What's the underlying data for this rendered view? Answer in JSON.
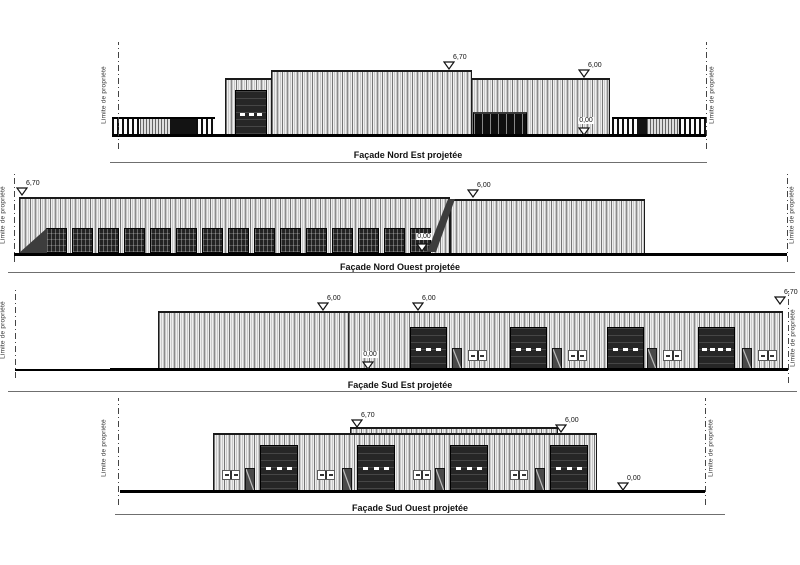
{
  "drawing": {
    "property_limit_label": "Limite de propriété",
    "colors": {
      "line": "#1a1a1a",
      "cladding": "#efefef",
      "door_dark": "#262626",
      "ground": "#000000",
      "shade": "#3d3d3d"
    },
    "elevations": [
      {
        "name": "facade-nord-est",
        "title": "Façade Nord Est projetée",
        "title_cx": 408,
        "title_y": 150,
        "underline": {
          "x1": 110,
          "x2": 707,
          "y": 162
        },
        "property_lines": [
          {
            "x": 118,
            "y1": 42,
            "y2": 149,
            "label_x": 104,
            "label_cy": 95
          },
          {
            "x": 706,
            "y1": 42,
            "y2": 149,
            "label_x": 712,
            "label_cy": 95
          }
        ],
        "grounds": [
          {
            "x1": 112,
            "x2": 706,
            "y": 134,
            "h": 3
          }
        ],
        "walls": [
          {
            "x": 225,
            "w": 47,
            "top": 78,
            "bot": 137
          },
          {
            "x": 271,
            "w": 201,
            "top": 70,
            "bot": 137
          },
          {
            "x": 471,
            "w": 139,
            "top": 78,
            "bot": 137
          }
        ],
        "fences": [
          {
            "x": 112,
            "w": 28,
            "top": 117,
            "bot": 134,
            "style": "bars"
          },
          {
            "x": 140,
            "w": 30,
            "top": 117,
            "bot": 134,
            "style": "hatch"
          },
          {
            "x": 170,
            "w": 26,
            "top": 117,
            "bot": 134,
            "style": "solid"
          },
          {
            "x": 196,
            "w": 19,
            "top": 117,
            "bot": 134,
            "style": "bars"
          },
          {
            "x": 612,
            "w": 25,
            "top": 117,
            "bot": 134,
            "style": "bars"
          },
          {
            "x": 637,
            "w": 10,
            "top": 117,
            "bot": 134,
            "style": "solid"
          },
          {
            "x": 647,
            "w": 32,
            "top": 117,
            "bot": 134,
            "style": "hatch"
          },
          {
            "x": 679,
            "w": 27,
            "top": 117,
            "bot": 134,
            "style": "bars"
          }
        ],
        "sectional_doors": [
          {
            "x": 235,
            "w": 32,
            "top": 90,
            "bot": 137,
            "dashes": 3
          }
        ],
        "glazings": [
          {
            "x": 473,
            "w": 54,
            "top": 112,
            "bot": 137
          }
        ],
        "markers": [
          {
            "label": "6,70",
            "x": 449,
            "y": 70,
            "box": false
          },
          {
            "label": "6,00",
            "x": 584,
            "y": 78,
            "box": false
          },
          {
            "label": "0,00",
            "x": 584,
            "y": 136,
            "box": true
          }
        ]
      },
      {
        "name": "facade-nord-ouest",
        "title": "Façade Nord Ouest projetée",
        "title_cx": 400,
        "title_y": 262,
        "underline": {
          "x1": 8,
          "x2": 795,
          "y": 272
        },
        "property_lines": [
          {
            "x": 14,
            "y1": 172,
            "y2": 262,
            "label_x": 3,
            "label_cy": 215
          },
          {
            "x": 787,
            "y1": 172,
            "y2": 262,
            "label_x": 792,
            "label_cy": 215
          }
        ],
        "grounds": [
          {
            "x1": 14,
            "x2": 787,
            "y": 253,
            "h": 3
          }
        ],
        "walls": [
          {
            "x": 19,
            "w": 431,
            "top": 197,
            "bot": 254
          },
          {
            "x": 450,
            "w": 195,
            "top": 199,
            "bot": 254
          }
        ],
        "grid_door_rows": [
          {
            "x": 46,
            "count": 15,
            "pitch": 26,
            "w": 21,
            "top": 228,
            "bot": 253
          }
        ],
        "shades": [
          {
            "points": "19,253 47,228 47,253"
          },
          {
            "points": "427,252 448,199 455,199 436,252"
          }
        ],
        "markers": [
          {
            "label": "6,70",
            "x": 22,
            "y": 196,
            "box": false
          },
          {
            "label": "6,00",
            "x": 473,
            "y": 198,
            "box": false
          },
          {
            "label": "0,00",
            "x": 422,
            "y": 252,
            "box": true
          }
        ]
      },
      {
        "name": "facade-sud-est",
        "title": "Façade Sud Est projetée",
        "title_cx": 400,
        "title_y": 380,
        "underline": {
          "x1": 8,
          "x2": 797,
          "y": 391
        },
        "property_lines": [
          {
            "x": 15,
            "y1": 289,
            "y2": 378,
            "label_x": 3,
            "label_cy": 330
          },
          {
            "x": 788,
            "y1": 291,
            "y2": 383,
            "label_x": 793,
            "label_cy": 338
          }
        ],
        "grounds": [
          {
            "x1": 15,
            "x2": 110,
            "y": 369,
            "h": 2
          },
          {
            "x1": 110,
            "x2": 788,
            "y": 368,
            "h": 3
          }
        ],
        "walls": [
          {
            "x": 158,
            "w": 625,
            "top": 311,
            "bot": 370
          }
        ],
        "joints": [
          {
            "x": 348,
            "y1": 311,
            "y2": 370
          }
        ],
        "sectional_doors": [
          {
            "x": 410,
            "w": 37,
            "top": 327,
            "bot": 370,
            "dashes": 3
          },
          {
            "x": 510,
            "w": 37,
            "top": 327,
            "bot": 370,
            "dashes": 3
          },
          {
            "x": 607,
            "w": 37,
            "top": 327,
            "bot": 370,
            "dashes": 3
          },
          {
            "x": 698,
            "w": 37,
            "top": 327,
            "bot": 370,
            "dashes": 4
          }
        ],
        "person_doors": [
          {
            "x": 452,
            "w": 10,
            "top": 348,
            "bot": 370
          },
          {
            "x": 552,
            "w": 10,
            "top": 348,
            "bot": 370
          },
          {
            "x": 647,
            "w": 10,
            "top": 348,
            "bot": 370
          },
          {
            "x": 742,
            "w": 10,
            "top": 348,
            "bot": 370
          }
        ],
        "windows": [
          {
            "x": 468,
            "w": 19,
            "top": 350,
            "bot": 361
          },
          {
            "x": 568,
            "w": 19,
            "top": 350,
            "bot": 361
          },
          {
            "x": 663,
            "w": 19,
            "top": 350,
            "bot": 361
          },
          {
            "x": 758,
            "w": 19,
            "top": 350,
            "bot": 361
          }
        ],
        "markers": [
          {
            "label": "6,00",
            "x": 323,
            "y": 311,
            "box": false
          },
          {
            "label": "6,00",
            "x": 418,
            "y": 311,
            "box": false
          },
          {
            "label": "0,00",
            "x": 368,
            "y": 370,
            "box": true
          },
          {
            "label": "6,70",
            "x": 780,
            "y": 305,
            "box": false
          }
        ]
      },
      {
        "name": "facade-sud-ouest",
        "title": "Façade Sud Ouest projetée",
        "title_cx": 410,
        "title_y": 503,
        "underline": {
          "x1": 115,
          "x2": 725,
          "y": 514
        },
        "property_lines": [
          {
            "x": 118,
            "y1": 398,
            "y2": 505,
            "label_x": 104,
            "label_cy": 448
          },
          {
            "x": 705,
            "y1": 398,
            "y2": 505,
            "label_x": 711,
            "label_cy": 448
          }
        ],
        "grounds": [
          {
            "x1": 120,
            "x2": 705,
            "y": 490,
            "h": 3
          }
        ],
        "walls": [
          {
            "x": 350,
            "w": 208,
            "top": 427,
            "bot": 434
          },
          {
            "x": 213,
            "w": 384,
            "top": 433,
            "bot": 492
          }
        ],
        "windows": [
          {
            "x": 222,
            "w": 18,
            "top": 470,
            "bot": 480
          },
          {
            "x": 317,
            "w": 18,
            "top": 470,
            "bot": 480
          },
          {
            "x": 413,
            "w": 18,
            "top": 470,
            "bot": 480
          },
          {
            "x": 510,
            "w": 18,
            "top": 470,
            "bot": 480
          }
        ],
        "person_doors": [
          {
            "x": 245,
            "w": 10,
            "top": 468,
            "bot": 492
          },
          {
            "x": 342,
            "w": 10,
            "top": 468,
            "bot": 492
          },
          {
            "x": 435,
            "w": 10,
            "top": 468,
            "bot": 492
          },
          {
            "x": 535,
            "w": 10,
            "top": 468,
            "bot": 492
          }
        ],
        "sectional_doors": [
          {
            "x": 260,
            "w": 38,
            "top": 445,
            "bot": 491,
            "dashes": 3
          },
          {
            "x": 357,
            "w": 38,
            "top": 445,
            "bot": 491,
            "dashes": 3
          },
          {
            "x": 450,
            "w": 38,
            "top": 445,
            "bot": 491,
            "dashes": 3
          },
          {
            "x": 550,
            "w": 38,
            "top": 445,
            "bot": 491,
            "dashes": 3
          }
        ],
        "markers": [
          {
            "label": "6,70",
            "x": 357,
            "y": 428,
            "box": false
          },
          {
            "label": "6,00",
            "x": 561,
            "y": 433,
            "box": false
          },
          {
            "label": "0,00",
            "x": 623,
            "y": 491,
            "box": false
          }
        ]
      }
    ]
  }
}
